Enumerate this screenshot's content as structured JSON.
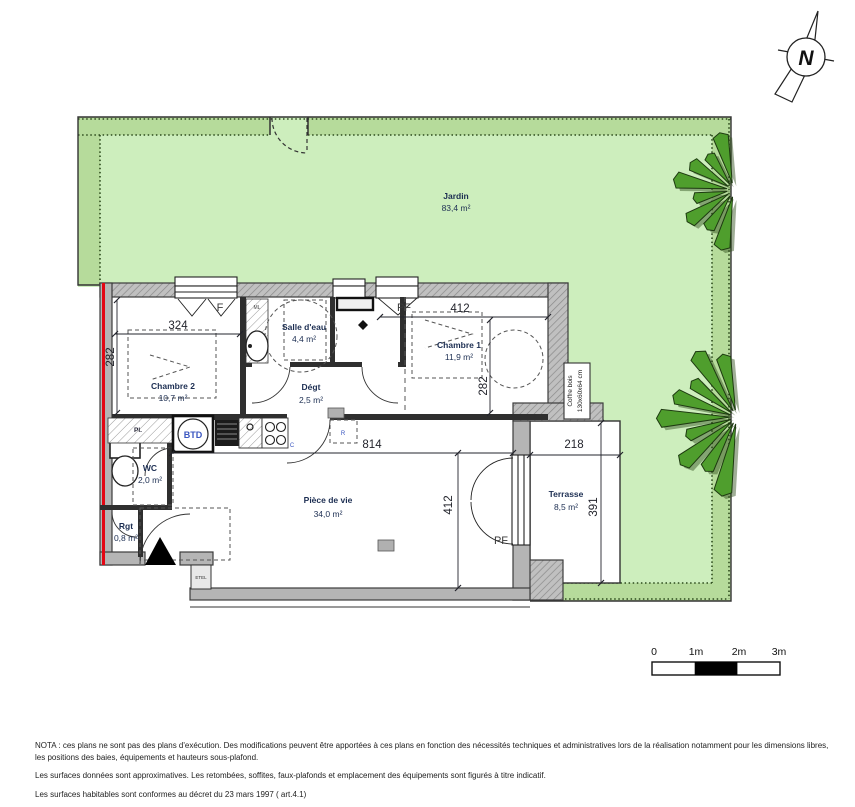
{
  "plan": {
    "compass_label": "N",
    "garden": {
      "name": "Jardin",
      "area": "83,4 m²"
    },
    "rooms": {
      "chambre2": {
        "name": "Chambre 2",
        "area": "10,7 m²"
      },
      "salle_deau": {
        "name": "Salle d'eau",
        "area": "4,4 m²"
      },
      "degagement": {
        "name": "Dégt",
        "area": "2,5 m²"
      },
      "chambre1": {
        "name": "Chambre 1",
        "area": "11,9 m²"
      },
      "wc": {
        "name": "WC",
        "area": "2,0 m²"
      },
      "rangement": {
        "name": "Rgt",
        "area": "0,8 m²"
      },
      "piece_de_vie": {
        "name": "Pièce de vie",
        "area": "34,0 m²"
      },
      "terrasse": {
        "name": "Terrasse",
        "area": "8,5 m²"
      }
    },
    "dimensions_cm": {
      "chambre2_width": "324",
      "chambre2_depth": "282",
      "chambre1_width": "412",
      "chambre1_depth": "282",
      "piece_de_vie_width": "814",
      "piece_de_vie_depth": "412",
      "terrasse_width": "218",
      "terrasse_depth": "391"
    },
    "labels": {
      "window_f": "F",
      "french_window_top": "PF",
      "french_window_terrasse": "PF",
      "btd": "BTD",
      "cooktop": "C",
      "fridge": "R",
      "washing_machine": "ML",
      "placard": "Pl.",
      "etel": "ETEL",
      "coffre_line1": "Coffre bois",
      "coffre_line2": "130x60x64 cm"
    },
    "scale_bar": {
      "tick0": "0",
      "tick1": "1m",
      "tick2": "2m",
      "tick3": "3m"
    },
    "notes": {
      "nota": "NOTA : ces plans ne sont pas des plans d'exécution. Des modifications peuvent être apportées à ces plans en fonction des nécessités techniques et administratives lors de la réalisation notamment pour les dimensions libres, les positions des baies, équipements et hauteurs sous-plafond.",
      "line2": "Les surfaces données sont approximatives. Les retombées, soffites, faux-plafonds et emplacement des équipements sont figurés à titre indicatif.",
      "line3": "Les surfaces habitables sont conformes au décret du 23 mars 1997 ( art.4.1)"
    },
    "colors": {
      "lawn": "#cdeebd",
      "hedge": "#b6db9b",
      "tree": "#4f9e2d",
      "wall": "#b5b5b5",
      "boundary_red": "#e30613"
    }
  }
}
